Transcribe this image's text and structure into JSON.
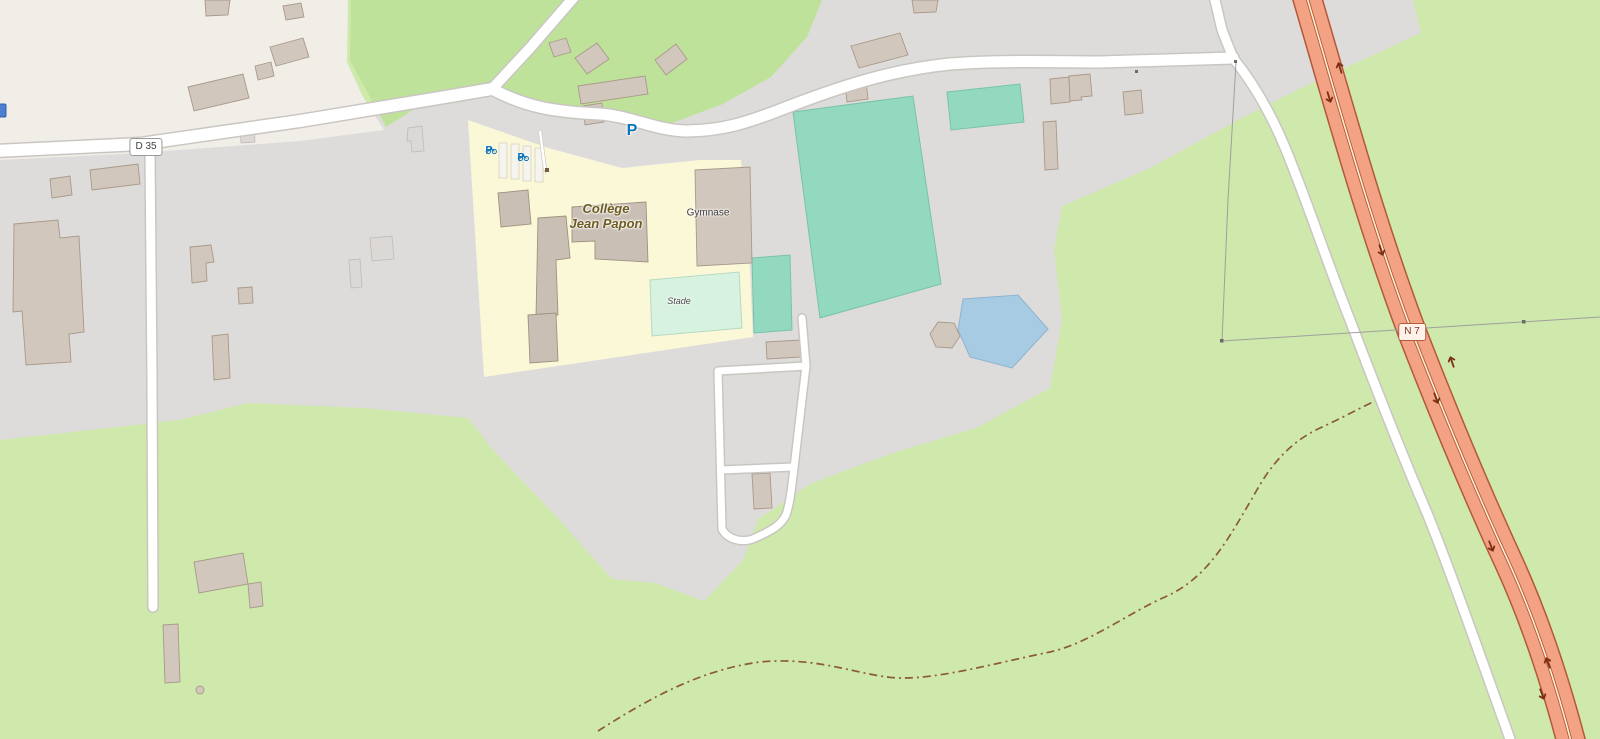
{
  "map": {
    "title": "Map of Collège Jean Papon area (OpenStreetMap style)",
    "road_labels": {
      "d35": "D 35",
      "n7": "N 7"
    },
    "poi_labels": {
      "college_line1": "Collège",
      "college_line2": "Jean Papon",
      "gymnase": "Gymnase",
      "stade": "Stade"
    },
    "icons": {
      "parking": "P",
      "bicycle_parking_1": "P",
      "bicycle_parking_2": "P"
    }
  },
  "colors": {
    "green-meadow": "#cee9ab",
    "green-grass": "#bfe29a",
    "farmland": "#f1eee8",
    "residential": "#dedcda",
    "school-area": "#fbf8d8",
    "pitch": "#93d9c0",
    "pitch-border": "#78c3a7",
    "stade-field": "#d8f2e1",
    "water": "#a6cbe2",
    "building": "#d1c7bc",
    "building-border": "#a9998a",
    "building-light": "#dbd8d5",
    "school-building": "#c9bfb5",
    "road-fill": "#ffffff",
    "road-casing": "#c9c6c2",
    "trunk-fill": "#f3a284",
    "trunk-casing": "#b2593a",
    "trunk-median": "#fbf0cf",
    "oneway-arrow": "#7c2f12",
    "track": "#8c5a3a",
    "powerline": "#9f9f9f",
    "parking-blue": "#0d74b8",
    "school-label": "#6f5b1d",
    "ref-box-border": "#9a9a9a",
    "n7-box-bg": "#fdf1ea",
    "n7-box-border": "#b05c3c",
    "n7-box-text": "#7c3a1d",
    "label-dark": "#3c3c3c"
  }
}
